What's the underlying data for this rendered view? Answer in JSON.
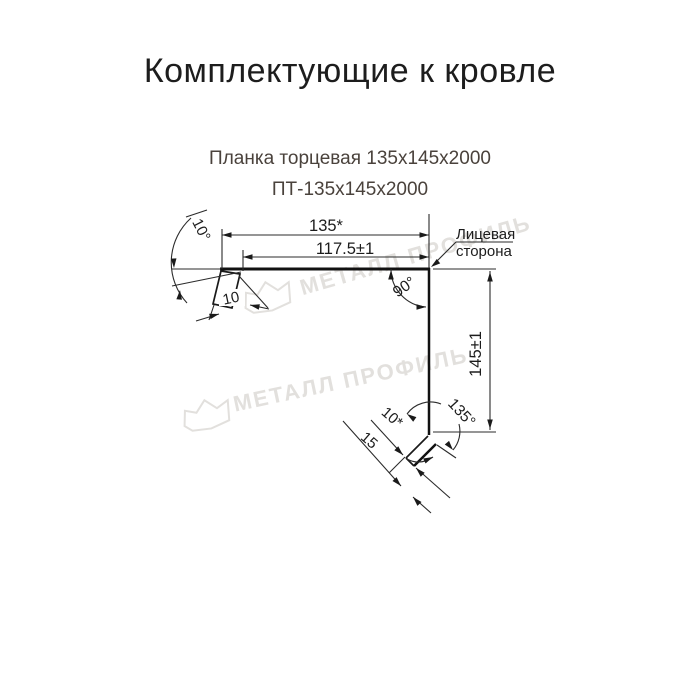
{
  "page": {
    "title": "Комплектующие к кровле"
  },
  "product": {
    "name": "Планка торцевая 135х145х2000",
    "code": "ПТ-135х145х2000"
  },
  "drawing": {
    "dims": {
      "width_total": "135*",
      "width_flat": "117.5±1",
      "height": "145±1",
      "hem_top": "10",
      "hem_bottom_width": "10*",
      "hem_bottom_length": "15"
    },
    "angles": {
      "top_left": "10°",
      "corner": "90°",
      "bottom": "135°"
    },
    "face_label": {
      "line1": "Лицевая",
      "line2": "сторона"
    }
  },
  "watermark": {
    "text": "МЕТАЛЛ ПРОФИЛЬ",
    "color": "#e2e0dd"
  },
  "colors": {
    "background": "#ffffff",
    "line": "#1a1a1a",
    "subtitle": "#4a423c"
  }
}
